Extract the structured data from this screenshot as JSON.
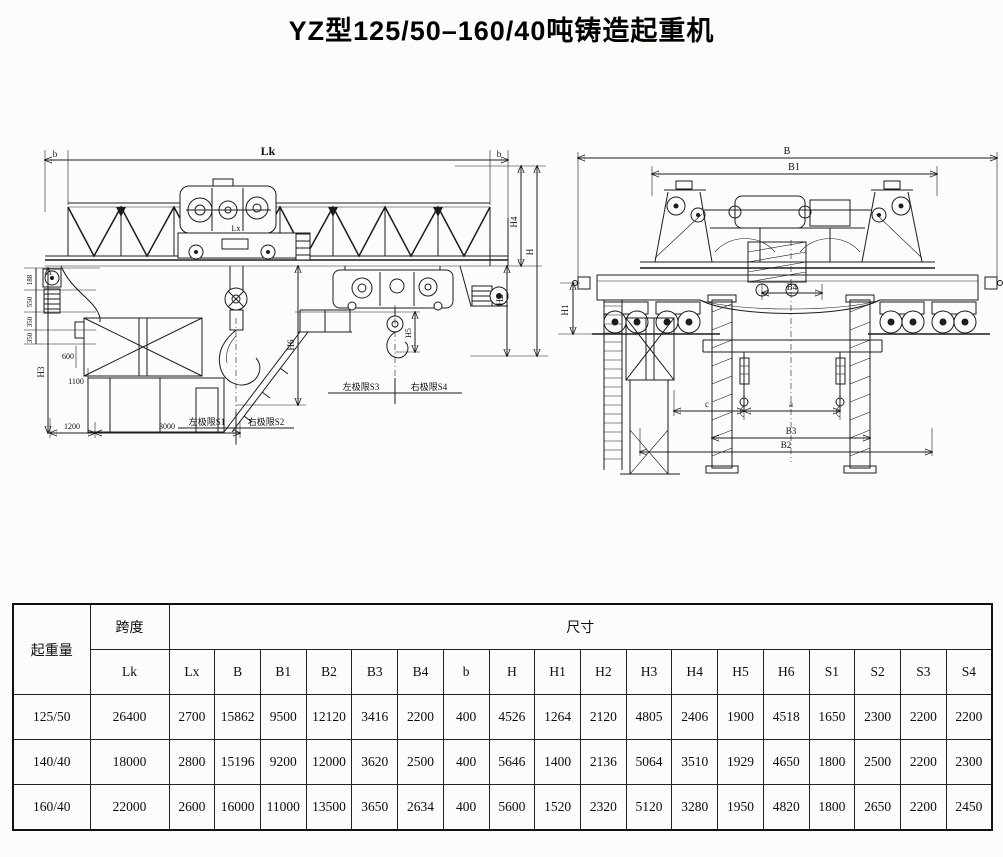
{
  "page": {
    "title": "YZ型125/50–160/40吨铸造起重机"
  },
  "side_view": {
    "dim_lk": "Lk",
    "dim_b_left": "b",
    "dim_b_right": "b",
    "dim_lx": "Lx",
    "dim_h4": "H4",
    "dim_h": "H",
    "dim_h2": "H2",
    "dim_h6": "H6",
    "dim_h5": "H5",
    "dim_h3": "H3",
    "dim_188": "188",
    "dim_550": "550",
    "dim_350a": "350",
    "dim_350b": "350",
    "dim_600": "600",
    "dim_1100": "1100",
    "dim_1200": "1200",
    "dim_3000": "3000",
    "limit_s1": "左极限S1",
    "limit_s2": "右极限S2",
    "limit_s3": "左极限S3",
    "limit_s4": "右极限S4"
  },
  "end_view": {
    "dim_b": "B",
    "dim_b1": "B1",
    "dim_b2": "B2",
    "dim_b3": "B3",
    "dim_b4": "B4",
    "dim_h1": "H1",
    "dim_c": "c",
    "dim_a": "a"
  },
  "table": {
    "header_capacity": "起重量",
    "header_span": "跨度",
    "header_span_sub": "Lk",
    "header_size": "尺寸",
    "size_columns": [
      "Lx",
      "B",
      "B1",
      "B2",
      "B3",
      "B4",
      "b",
      "H",
      "H1",
      "H2",
      "H3",
      "H4",
      "H5",
      "H6",
      "S1",
      "S2",
      "S3",
      "S4"
    ],
    "rows": [
      {
        "capacity": "125/50",
        "lk": "26400",
        "v": [
          "2700",
          "15862",
          "9500",
          "12120",
          "3416",
          "2200",
          "400",
          "4526",
          "1264",
          "2120",
          "4805",
          "2406",
          "1900",
          "4518",
          "1650",
          "2300",
          "2200",
          "2200"
        ]
      },
      {
        "capacity": "140/40",
        "lk": "18000",
        "v": [
          "2800",
          "15196",
          "9200",
          "12000",
          "3620",
          "2500",
          "400",
          "5646",
          "1400",
          "2136",
          "5064",
          "3510",
          "1929",
          "4650",
          "1800",
          "2500",
          "2200",
          "2300"
        ]
      },
      {
        "capacity": "160/40",
        "lk": "22000",
        "v": [
          "2600",
          "16000",
          "11000",
          "13500",
          "3650",
          "2634",
          "400",
          "5600",
          "1520",
          "2320",
          "5120",
          "3280",
          "1950",
          "4820",
          "1800",
          "2650",
          "2200",
          "2450"
        ]
      }
    ]
  }
}
